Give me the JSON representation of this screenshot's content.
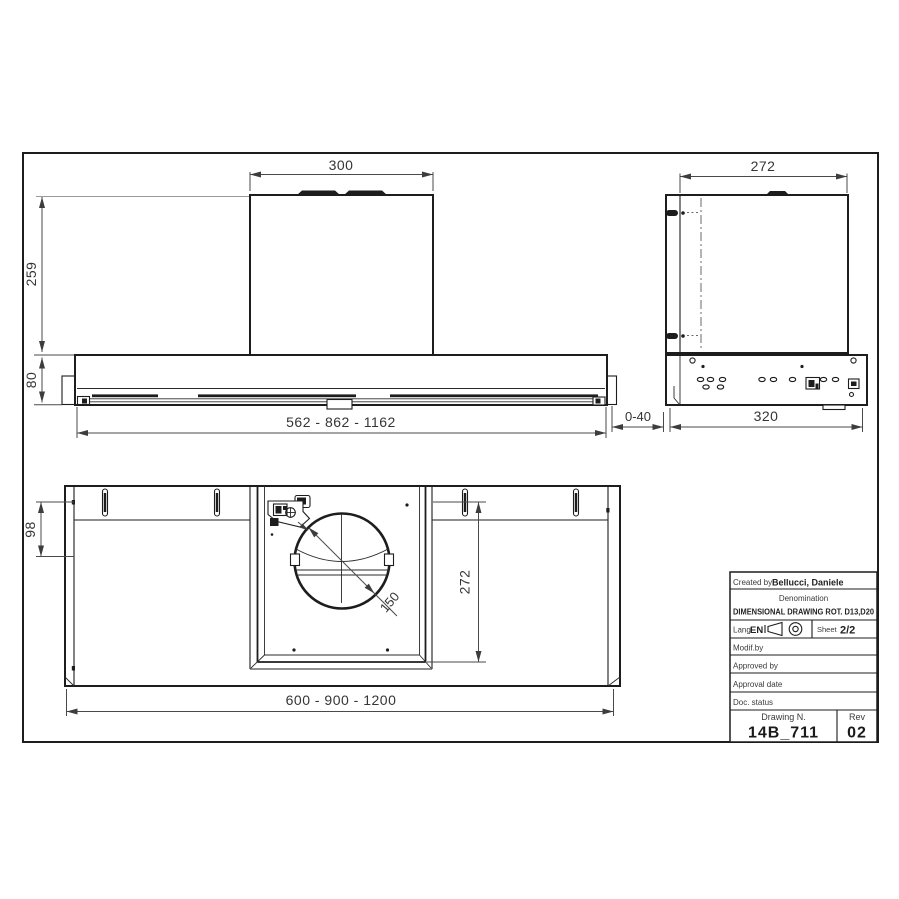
{
  "colors": {
    "line": "#1d1d1d",
    "dim": "#4a4a4a",
    "background": "#ffffff"
  },
  "front_view": {
    "top_width": "300",
    "chimney_height": "259",
    "body_height": "80",
    "body_widths": "562 - 862 - 1162",
    "wall_gap": "0-40"
  },
  "side_view": {
    "top_width": "272",
    "depth": "320"
  },
  "bottom_view": {
    "rear_depth": "98",
    "opening_depth": "272",
    "duct_diameter": "150",
    "body_widths": "600 - 900 - 1200"
  },
  "title_block": {
    "created_by_label": "Created by",
    "created_by": "Bellucci, Daniele",
    "denomination_label": "Denomination",
    "denomination": "DIMENSIONAL DRAWING ROT. D13,D20",
    "lang_label": "Lang",
    "lang": "EN",
    "sheet_label": "Sheet",
    "sheet": "2/2",
    "modif_by_label": "Modif.by",
    "approved_by_label": "Approved by",
    "approval_date_label": "Approval date",
    "doc_status_label": "Doc. status",
    "drawing_n_label": "Drawing N.",
    "drawing_n": "14B_711",
    "rev_label": "Rev",
    "rev": "02"
  }
}
